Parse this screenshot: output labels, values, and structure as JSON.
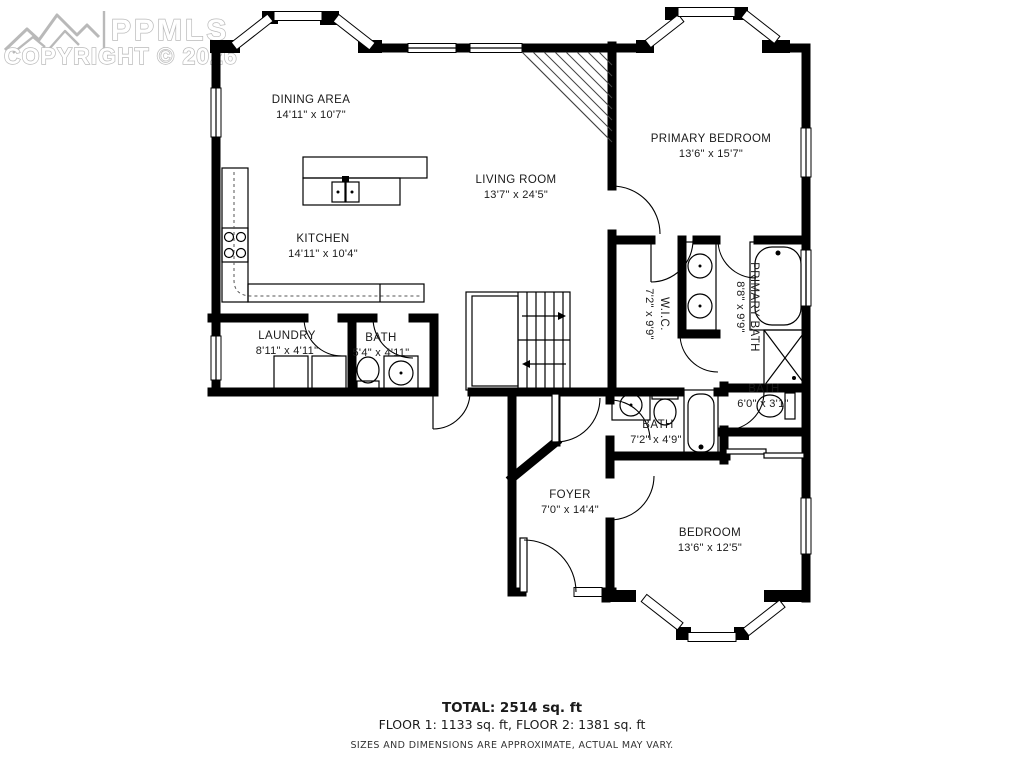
{
  "watermark": {
    "brand": "PPMLS",
    "copyright": "COPYRIGHT © 2026"
  },
  "colors": {
    "wall": "#000000",
    "watermark_gray": "#b9b9b9",
    "background": "#ffffff"
  },
  "rooms": {
    "dining": {
      "name": "DINING AREA",
      "dims": "14'11\" x 10'7\""
    },
    "living": {
      "name": "LIVING ROOM",
      "dims": "13'7\" x 24'5\""
    },
    "primary_bedroom": {
      "name": "PRIMARY BEDROOM",
      "dims": "13'6\" x 15'7\""
    },
    "kitchen": {
      "name": "KITCHEN",
      "dims": "14'11\" x 10'4\""
    },
    "wic": {
      "name": "W.I.C.",
      "dims": "7'2\" x 9'9\""
    },
    "primary_bath": {
      "name": "PRIMARY BATH",
      "dims": "8'8\" x 9'9\""
    },
    "laundry": {
      "name": "LAUNDRY",
      "dims": "8'11\" x 4'11\""
    },
    "bath_main": {
      "name": "BATH",
      "dims": "5'4\" x 4'11\""
    },
    "bath_hall": {
      "name": "BATH",
      "dims": "7'2\" x 4'9\""
    },
    "bath_small": {
      "name": "BATH",
      "dims": "6'0\" x 3'1\""
    },
    "foyer": {
      "name": "FOYER",
      "dims": "7'0\" x 14'4\""
    },
    "bedroom": {
      "name": "BEDROOM",
      "dims": "13'6\" x 12'5\""
    }
  },
  "footer": {
    "total": "TOTAL: 2514 sq. ft",
    "floors": "FLOOR 1: 1133 sq. ft, FLOOR 2: 1381 sq. ft",
    "disclaimer": "SIZES AND DIMENSIONS ARE APPROXIMATE, ACTUAL MAY VARY."
  }
}
